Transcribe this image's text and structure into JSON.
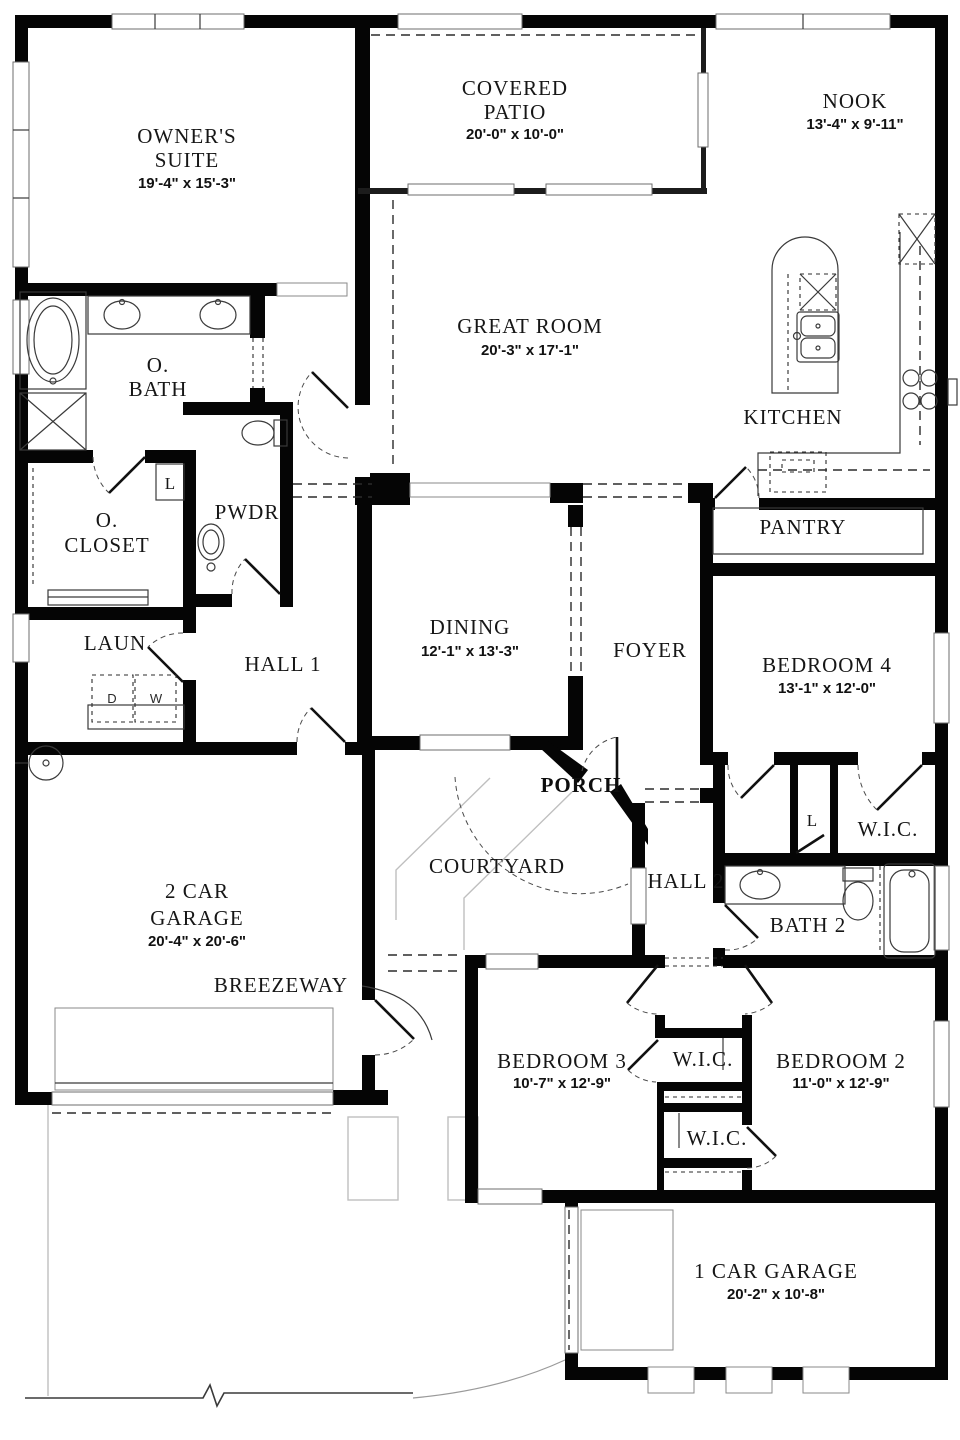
{
  "plan": {
    "type": "single-story residential floor plan",
    "wall_color": "#050505",
    "site_line_color": "#bfbfbf",
    "background": "#ffffff"
  },
  "rooms": {
    "owners_suite": {
      "line1": "OWNER'S",
      "line2": "SUITE",
      "dims": "19'-4\" x 15'-3\""
    },
    "covered_patio": {
      "line1": "COVERED",
      "line2": "PATIO",
      "dims": "20'-0\" x 10'-0\""
    },
    "nook": {
      "line1": "NOOK",
      "dims": "13'-4\" x 9'-11\""
    },
    "great_room": {
      "line1": "GREAT ROOM",
      "dims": "20'-3\" x 17'-1\""
    },
    "kitchen": {
      "line1": "KITCHEN"
    },
    "owners_bath": {
      "line1": "O.",
      "line2": "BATH"
    },
    "owners_closet": {
      "line1": "O.",
      "line2": "CLOSET"
    },
    "powder": {
      "line1": "PWDR"
    },
    "pantry": {
      "line1": "PANTRY"
    },
    "laundry": {
      "line1": "LAUN"
    },
    "hall1": {
      "line1": "HALL 1"
    },
    "dining": {
      "line1": "DINING",
      "dims": "12'-1\" x 13'-3\""
    },
    "foyer": {
      "line1": "FOYER"
    },
    "bedroom4": {
      "line1": "BEDROOM 4",
      "dims": "13'-1\" x 12'-0\""
    },
    "porch": {
      "line1": "PORCH"
    },
    "courtyard": {
      "line1": "COURTYARD"
    },
    "hall2": {
      "line1": "HALL 2"
    },
    "wic_bedroom4": {
      "line1": "W.I.C."
    },
    "bath2": {
      "line1": "BATH 2"
    },
    "garage2": {
      "line1": "2 CAR",
      "line2": "GARAGE",
      "dims": "20'-4\" x 20'-6\""
    },
    "breezeway": {
      "line1": "BREEZEWAY"
    },
    "bedroom3": {
      "line1": "BEDROOM 3",
      "dims": "10'-7\" x 12'-9\""
    },
    "wic_center": {
      "line1": "W.I.C."
    },
    "bedroom2": {
      "line1": "BEDROOM 2",
      "dims": "11'-0\" x 12'-9\""
    },
    "wic_lower": {
      "line1": "W.I.C."
    },
    "garage1": {
      "line1": "1 CAR GARAGE",
      "dims": "20'-2\" x 10'-8\""
    }
  },
  "appliance_labels": {
    "dryer": "D",
    "washer": "W",
    "linen_closet": "L",
    "linen_hall2": "L"
  }
}
